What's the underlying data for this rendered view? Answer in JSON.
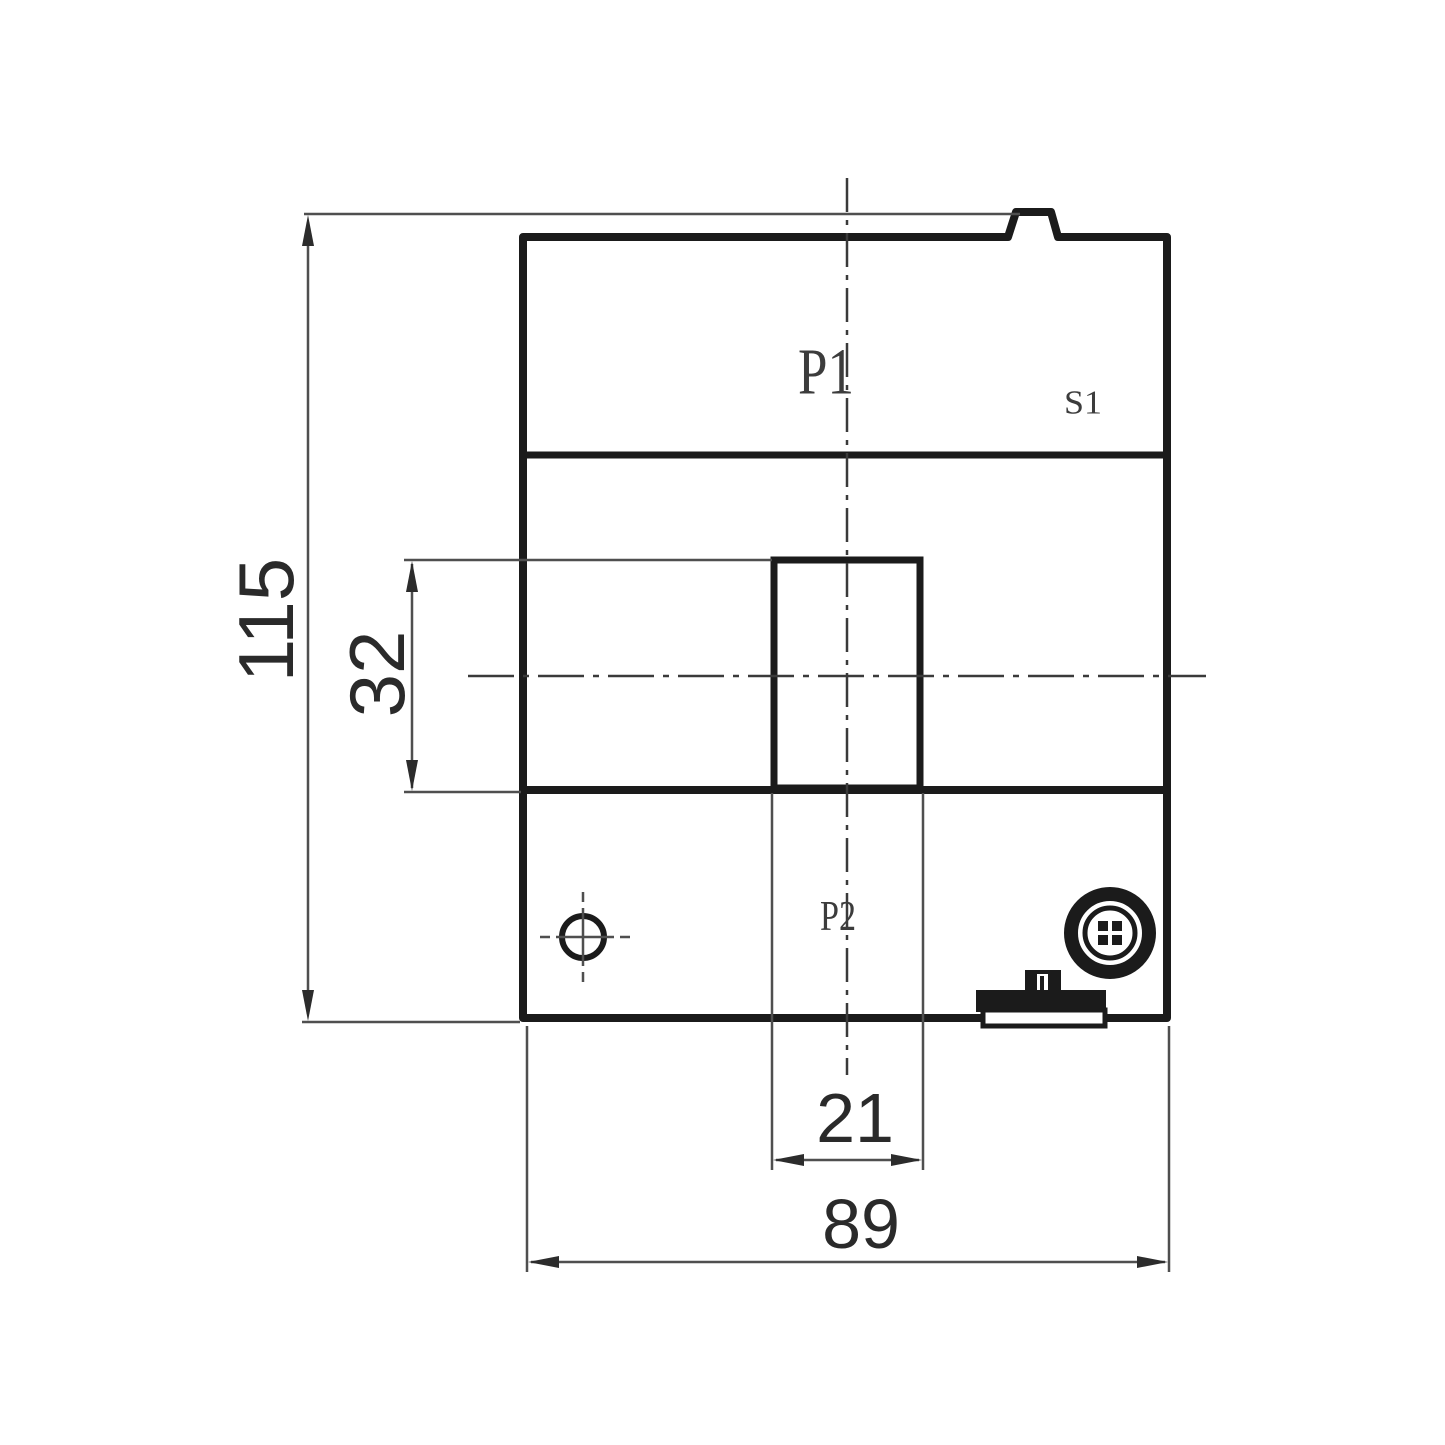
{
  "colors": {
    "line": "#1b1b1b",
    "thin": "#4f4f4f",
    "bg": "#ffffff",
    "dim_text": "#2a2a2a",
    "label_text": "#3c3c3c",
    "sublabel_text": "#565656"
  },
  "labels": {
    "primary_top": "P1",
    "secondary_top": "S1",
    "primary_bottom": "P2"
  },
  "dimensions": {
    "overall_height": "115",
    "aperture_height": "32",
    "aperture_width": "21",
    "overall_width": "89"
  },
  "icons": {
    "mounting_hole": "mounting-hole-crosshair-icon",
    "terminal": "terminal-connector-icon",
    "rail_clip": "din-rail-clip-icon"
  }
}
